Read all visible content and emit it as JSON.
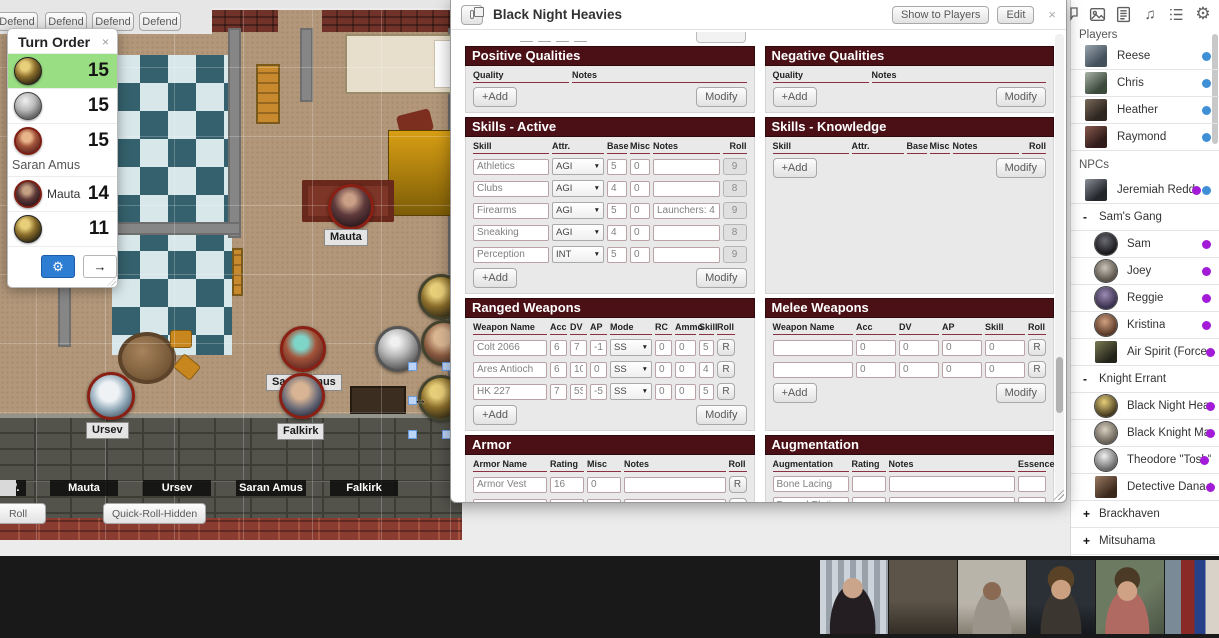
{
  "colors": {
    "section_header": "#4a1016",
    "active_turn_highlight": "#9ade84",
    "player_online_dot": "#3f8fd6",
    "npc_dot": "#a21bd6",
    "gear_button": "#2d7dd2"
  },
  "glyphs": {
    "close": "×",
    "dropdown": "▼",
    "gear": "⚙",
    "advance": "→",
    "music": "♫",
    "expand": "+",
    "collapse": "-",
    "drag": "↔"
  },
  "defend": {
    "labels": [
      "Defend",
      "Defend",
      "Defend",
      "Defend"
    ]
  },
  "turn_order": {
    "title": "Turn Order",
    "entries": [
      {
        "name": "",
        "initiative": "15"
      },
      {
        "name": "",
        "initiative": "15"
      },
      {
        "name": "Saran Amus",
        "initiative": "15"
      },
      {
        "name": "Mauta",
        "initiative": "14"
      },
      {
        "name": "",
        "initiative": "11"
      }
    ]
  },
  "map": {
    "labels": {
      "mauta": "Mauta",
      "ursev": "Ursev",
      "falkirk": "Falkirk",
      "saran": "Saran Amus"
    }
  },
  "sheet": {
    "title": "Black Night Heavies",
    "show_to_players": "Show to Players",
    "edit": "Edit",
    "pos_qual": {
      "title": "Positive Qualities",
      "col_quality": "Quality",
      "col_notes": "Notes",
      "add": "+Add",
      "modify": "Modify"
    },
    "neg_qual": {
      "title": "Negative Qualities",
      "col_quality": "Quality",
      "col_notes": "Notes",
      "add": "+Add",
      "modify": "Modify"
    },
    "skills_active": {
      "title": "Skills - Active",
      "cols": {
        "skill": "Skill",
        "attr": "Attr.",
        "base": "Base",
        "misc": "Misc",
        "notes": "Notes",
        "roll": "Roll"
      },
      "rows": [
        {
          "skill": "Athletics",
          "attr": "AGI",
          "base": "5",
          "misc": "0",
          "notes": "",
          "roll": "9"
        },
        {
          "skill": "Clubs",
          "attr": "AGI",
          "base": "4",
          "misc": "0",
          "notes": "",
          "roll": "8"
        },
        {
          "skill": "Firearms",
          "attr": "AGI",
          "base": "5",
          "misc": "0",
          "notes": "Launchers: 4",
          "roll": "9"
        },
        {
          "skill": "Sneaking",
          "attr": "AGI",
          "base": "4",
          "misc": "0",
          "notes": "",
          "roll": "8"
        },
        {
          "skill": "Perception",
          "attr": "INT",
          "base": "5",
          "misc": "0",
          "notes": "",
          "roll": "9"
        }
      ],
      "add": "+Add",
      "modify": "Modify"
    },
    "skills_knowledge": {
      "title": "Skills - Knowledge",
      "cols": {
        "skill": "Skill",
        "attr": "Attr.",
        "base": "Base",
        "misc": "Misc",
        "notes": "Notes",
        "roll": "Roll"
      },
      "add": "+Add",
      "modify": "Modify"
    },
    "ranged": {
      "title": "Ranged Weapons",
      "cols": {
        "name": "Weapon Name",
        "acc": "Acc",
        "dv": "DV",
        "ap": "AP",
        "mode": "Mode",
        "rc": "RC",
        "ammo": "Ammo",
        "skill": "Skill",
        "roll": "Roll"
      },
      "rows": [
        {
          "name": "Colt 2066",
          "acc": "6",
          "dv": "7",
          "ap": "-1",
          "mode": "SS",
          "rc": "0",
          "ammo": "0",
          "skill": "5",
          "roll": "R"
        },
        {
          "name": "Ares Antioch",
          "acc": "6",
          "dv": "10S",
          "ap": "0",
          "mode": "SS",
          "rc": "0",
          "ammo": "0",
          "skill": "4",
          "roll": "R"
        },
        {
          "name": "HK 227",
          "acc": "7",
          "dv": "5S",
          "ap": "-5",
          "mode": "SS",
          "rc": "0",
          "ammo": "0",
          "skill": "5",
          "roll": "R"
        }
      ],
      "add": "+Add",
      "modify": "Modify"
    },
    "melee": {
      "title": "Melee Weapons",
      "cols": {
        "name": "Weapon Name",
        "acc": "Acc",
        "dv": "DV",
        "ap": "AP",
        "skill": "Skill",
        "roll": "Roll"
      },
      "rows": [
        {
          "name": "",
          "acc": "0",
          "dv": "0",
          "ap": "0",
          "skill": "0",
          "roll": "R"
        },
        {
          "name": "",
          "acc": "0",
          "dv": "0",
          "ap": "0",
          "skill": "0",
          "roll": "R"
        }
      ],
      "add": "+Add",
      "modify": "Modify"
    },
    "armor": {
      "title": "Armor",
      "cols": {
        "name": "Armor Name",
        "rating": "Rating",
        "misc": "Misc",
        "notes": "Notes",
        "roll": "Roll"
      },
      "rows": [
        {
          "name": "Armor Vest",
          "rating": "16",
          "misc": "0",
          "notes": "",
          "roll": "R"
        },
        {
          "name": "",
          "rating": "0",
          "misc": "0",
          "notes": "",
          "roll": "R"
        }
      ],
      "add": "+Add",
      "modify": "Modify",
      "notes_label": "Armor Notes:"
    },
    "aug": {
      "title": "Augmentation",
      "cols": {
        "name": "Augmentation",
        "rating": "Rating",
        "notes": "Notes",
        "essence": "Essence"
      },
      "rows": [
        {
          "name": "Bone Lacing",
          "rating": "",
          "notes": "",
          "essence": ""
        },
        {
          "name": "Dermal Plating",
          "rating": "",
          "notes": "",
          "essence": ""
        },
        {
          "name": "Synaptic Booster",
          "rating": "",
          "notes": "",
          "essence": ""
        }
      ],
      "add": "+Add",
      "modify": "Modify"
    }
  },
  "sidebar": {
    "players_label": "Players",
    "players": [
      {
        "name": "Reese"
      },
      {
        "name": "Chris"
      },
      {
        "name": "Heather"
      },
      {
        "name": "Raymond"
      }
    ],
    "npcs_label": "NPCs",
    "jeremiah": {
      "name": "Jeremiah Redd"
    },
    "sams_gang": {
      "label": "Sam's Gang",
      "members": [
        {
          "name": "Sam"
        },
        {
          "name": "Joey"
        },
        {
          "name": "Reggie"
        },
        {
          "name": "Kristina"
        },
        {
          "name": "Air Spirit (Force 4)"
        }
      ]
    },
    "knight_errant": {
      "label": "Knight Errant",
      "members": [
        {
          "name": "Black Night Heavies"
        },
        {
          "name": "Black Knight Mage"
        },
        {
          "name": "Theodore \"Tosh\" A"
        },
        {
          "name": "Detective Dana Oak"
        }
      ]
    },
    "brackhaven": {
      "label": "Brackhaven"
    },
    "mitsuhama": {
      "label": "Mitsuhama"
    }
  },
  "bottom": {
    "plates": [
      {
        "label": "W."
      },
      {
        "label": "Mauta"
      },
      {
        "label": "Ursev"
      },
      {
        "label": "Saran Amus"
      },
      {
        "label": "Falkirk"
      }
    ],
    "swatch_styles": [
      "background:#9b1fe8",
      "background:#611511",
      "background:#e5815a",
      "background:#e0760c",
      "background:#d9d9d9"
    ],
    "roll": "Roll",
    "quick_roll_hidden": "Quick-Roll-Hidden"
  }
}
